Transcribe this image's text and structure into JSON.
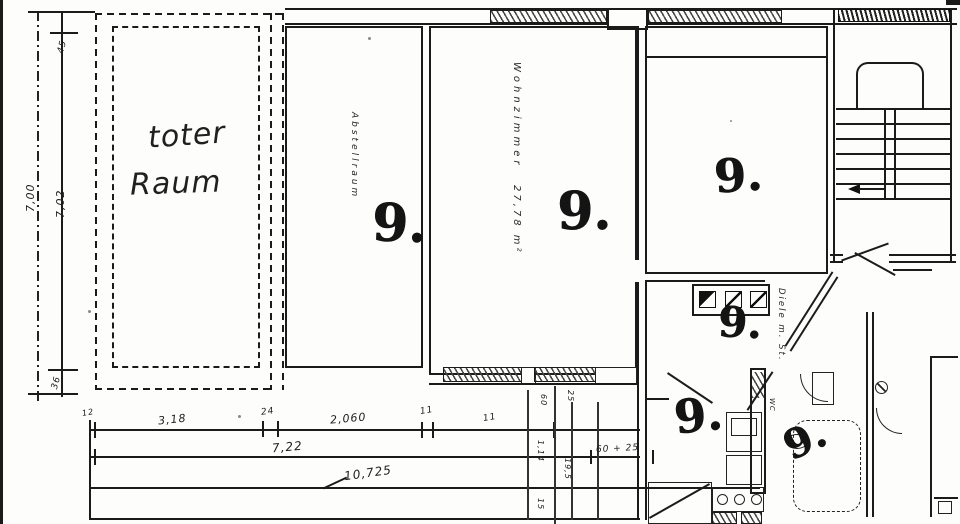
{
  "rooms": {
    "toter_line1": "toter",
    "toter_line2": "Raum",
    "abstellraum": "Abstellraum",
    "wohnzimmer_name": "Wohnzimmer",
    "wohnzimmer_area": "27,78 m²",
    "diele": "Diele m. St.",
    "wc": "WC"
  },
  "marks": [
    "9.",
    "9.",
    "9.",
    "9.",
    "9.",
    "9."
  ],
  "dims": {
    "left_outer": "7,00",
    "left_inner": "7,02",
    "left_top": "45",
    "left_bottom": "36",
    "row1": [
      "12",
      "3,18",
      "24",
      "2,060",
      "11",
      "11"
    ],
    "row2": "7,22",
    "row2_right": "60 + 25",
    "row3": "10,725",
    "vert": [
      "60",
      "25",
      "1,14",
      "19,5",
      "15"
    ]
  },
  "colors": {
    "ink": "#1b1b1b",
    "paper": "#fdfdfb"
  }
}
